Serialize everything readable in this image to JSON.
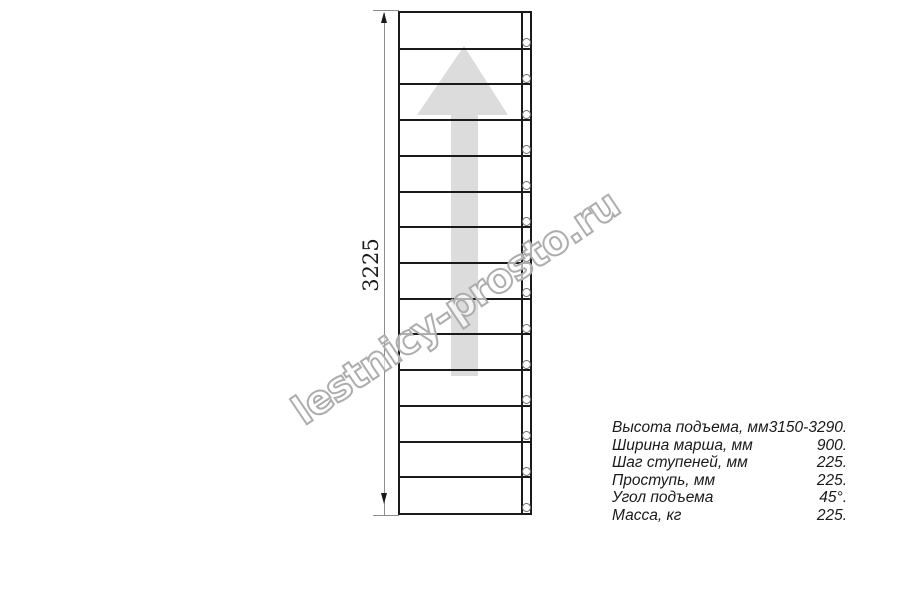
{
  "colors": {
    "background": "#ffffff",
    "line": "#1a1a1a",
    "dim_line": "#8c8c8c",
    "arrow_fill": "#dcdcdc",
    "watermark_stroke": "#adadad"
  },
  "drawing": {
    "dimension_label": "3225",
    "steps_count": 14,
    "bolt_count": 14
  },
  "watermark": {
    "text": "lestnicy-prosto.ru"
  },
  "specs": {
    "rows": [
      {
        "label": "Высота подъема, мм",
        "value": "3150-3290."
      },
      {
        "label": "Ширина марша, мм",
        "value": "900."
      },
      {
        "label": "Шаг ступеней, мм",
        "value": "225."
      },
      {
        "label": "Проступь, мм",
        "value": "225."
      },
      {
        "label": "Угол подъема",
        "value": "45°."
      },
      {
        "label": "Масса, кг",
        "value": "225."
      }
    ]
  }
}
